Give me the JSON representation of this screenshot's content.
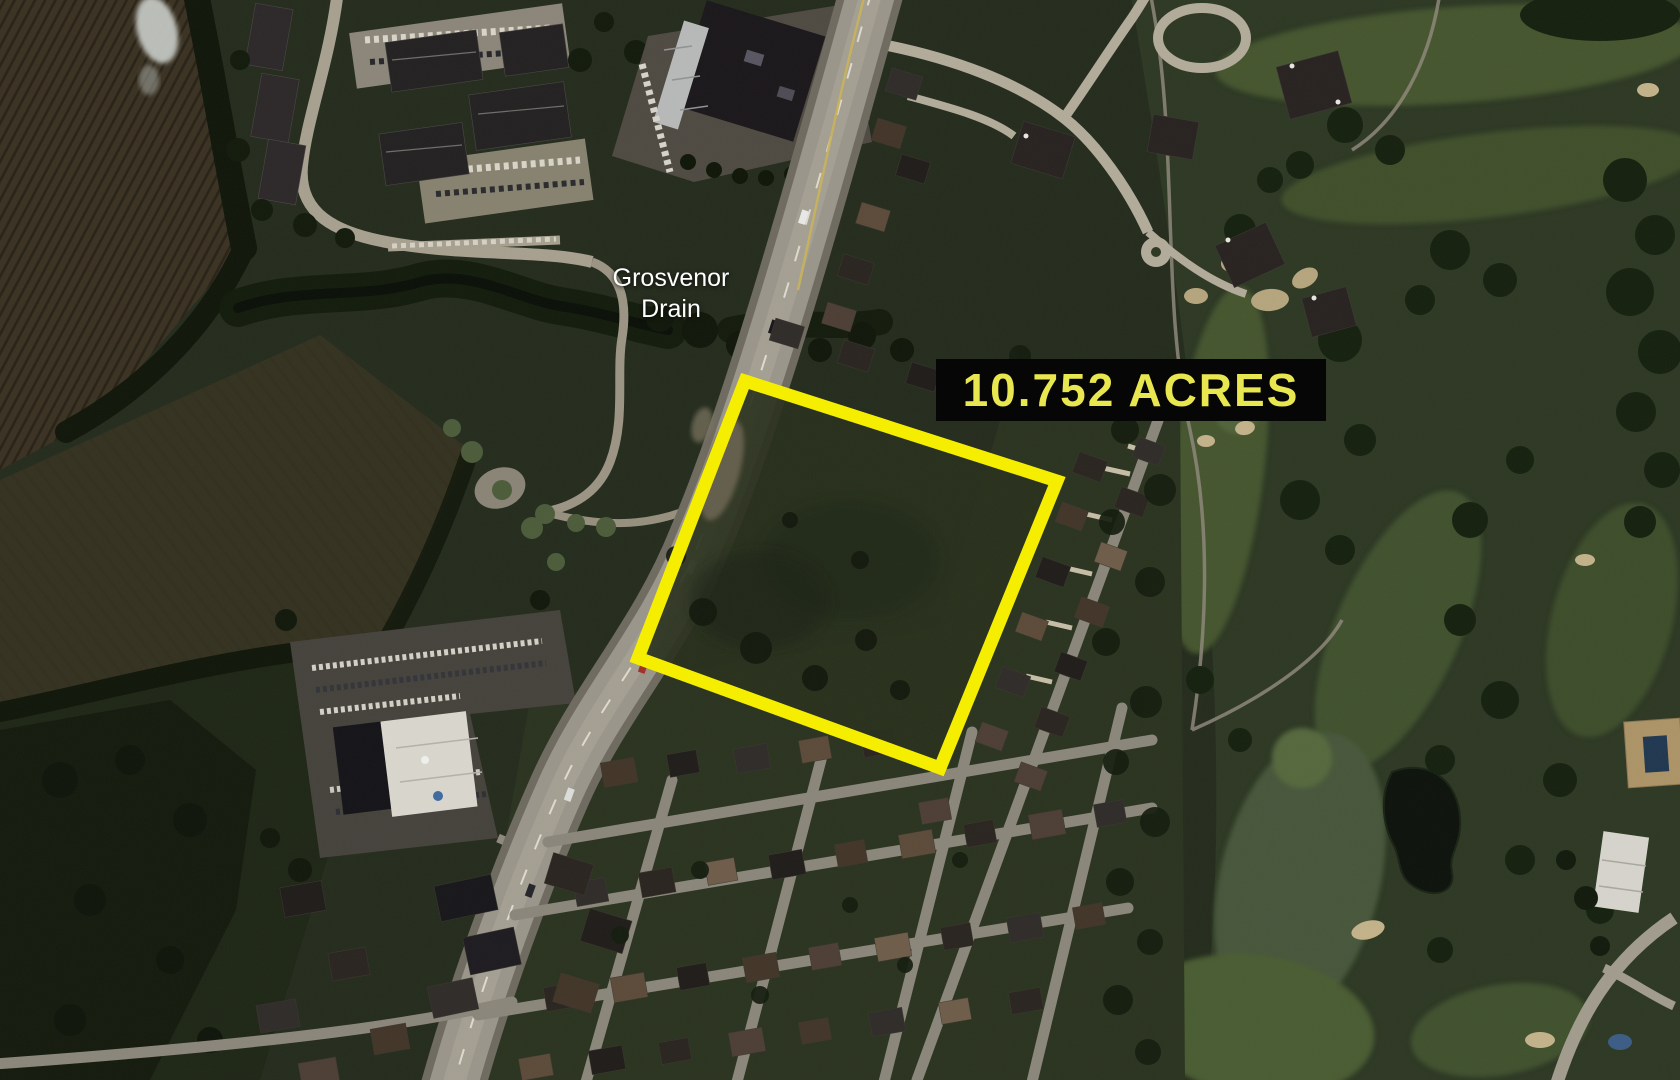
{
  "map": {
    "place_label": [
      "Grosvenor",
      "Drain"
    ],
    "place_label_color": "#ffffff"
  },
  "annotation": {
    "area_text": "10.752 ACRES",
    "box_bg": "#060606",
    "text_color": "#e9e74f",
    "outline_color": "#f6ee00"
  }
}
